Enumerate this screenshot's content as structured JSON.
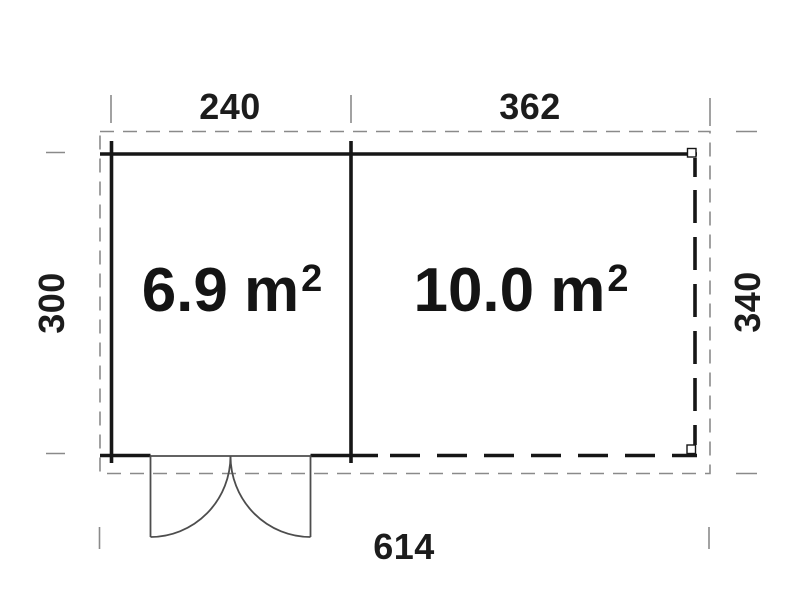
{
  "plan": {
    "rooms": [
      {
        "id": "room-left",
        "area_value": "6.9",
        "area_unit": "m",
        "area_exponent": "2"
      },
      {
        "id": "room-right",
        "area_value": "10.0",
        "area_unit": "m",
        "area_exponent": "2"
      }
    ],
    "dimensions": {
      "top_left_width": "240",
      "top_right_width": "362",
      "left_height": "300",
      "right_height": "340",
      "total_width": "614"
    },
    "colors": {
      "wall_line": "#161616",
      "roof_outline_dash": "#8a8a8a",
      "door_line": "#4d4d4d",
      "background": "#ffffff"
    }
  }
}
